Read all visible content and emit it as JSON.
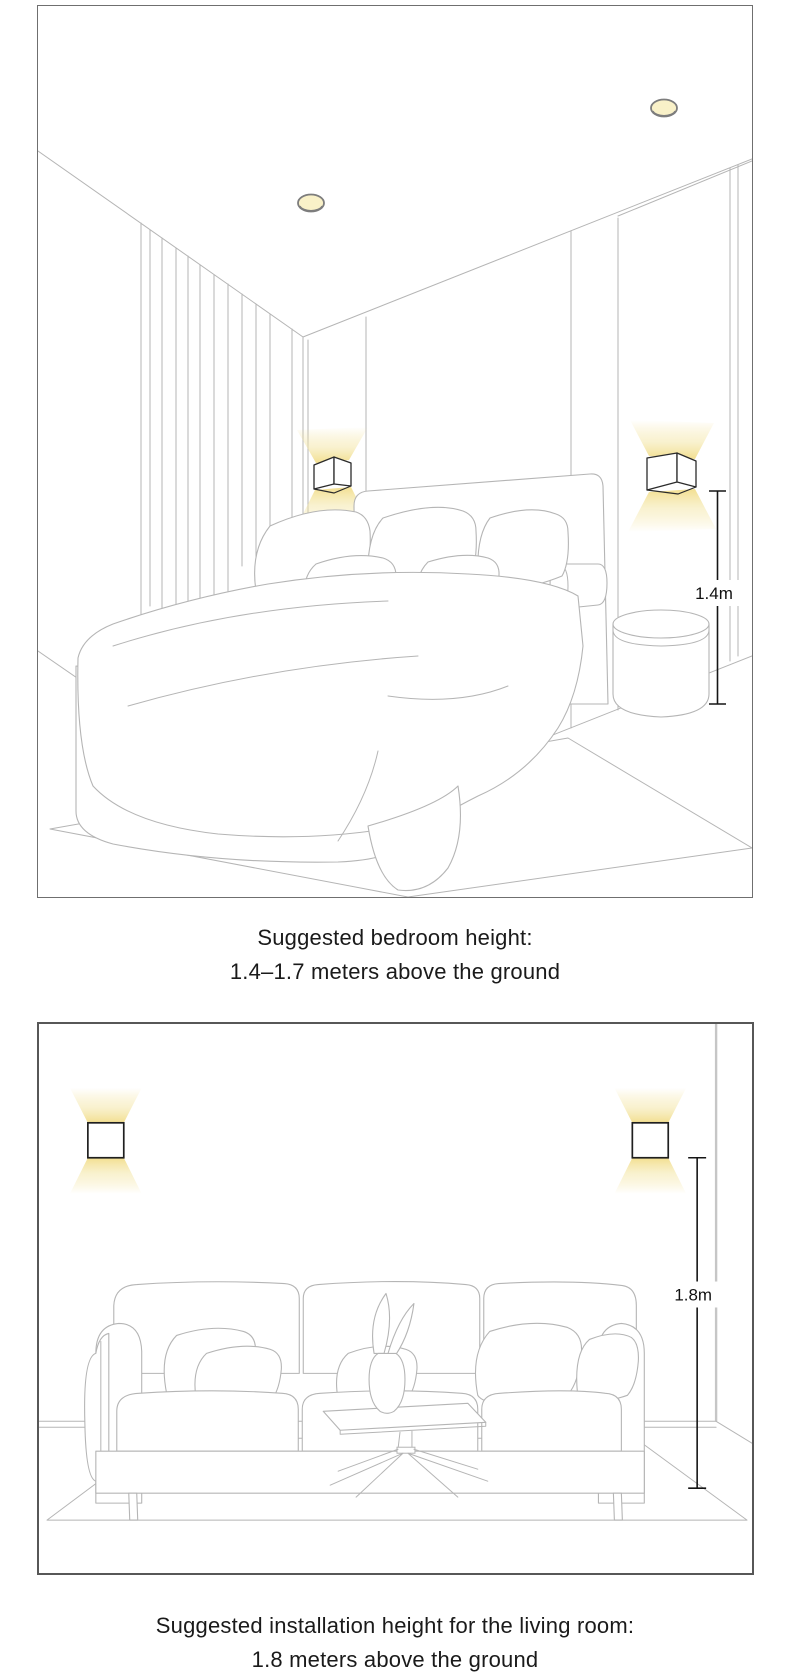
{
  "sections": [
    {
      "id": "bedroom",
      "caption_line1": "Suggested bedroom height:",
      "caption_line2": "1.4–1.7 meters above the ground",
      "measurement_label": "1.4m",
      "scene_items": [
        "ceiling downlights",
        "curtains",
        "two wall lamps with up/down glow",
        "bed with pillows",
        "round side table",
        "rug",
        "height measurement arrow"
      ]
    },
    {
      "id": "living-room",
      "caption_line1": "Suggested installation height for the living room:",
      "caption_line2": "1.8 meters above the ground",
      "measurement_label": "1.8m",
      "scene_items": [
        "two wall lamps with up/down glow",
        "three-seat sofa with cushions",
        "coffee table with vase",
        "rug",
        "height measurement arrow"
      ]
    }
  ],
  "colors": {
    "background": "#ffffff",
    "line_art": "#b5b5b5",
    "frame_border": "#5f5f5f",
    "lamp_outline": "#2b2b2b",
    "lamp_glow": "#f2dd8a",
    "downlight_fill": "#f9f1c8",
    "measurement": "#151515",
    "caption_text": "#1a1a1a"
  }
}
